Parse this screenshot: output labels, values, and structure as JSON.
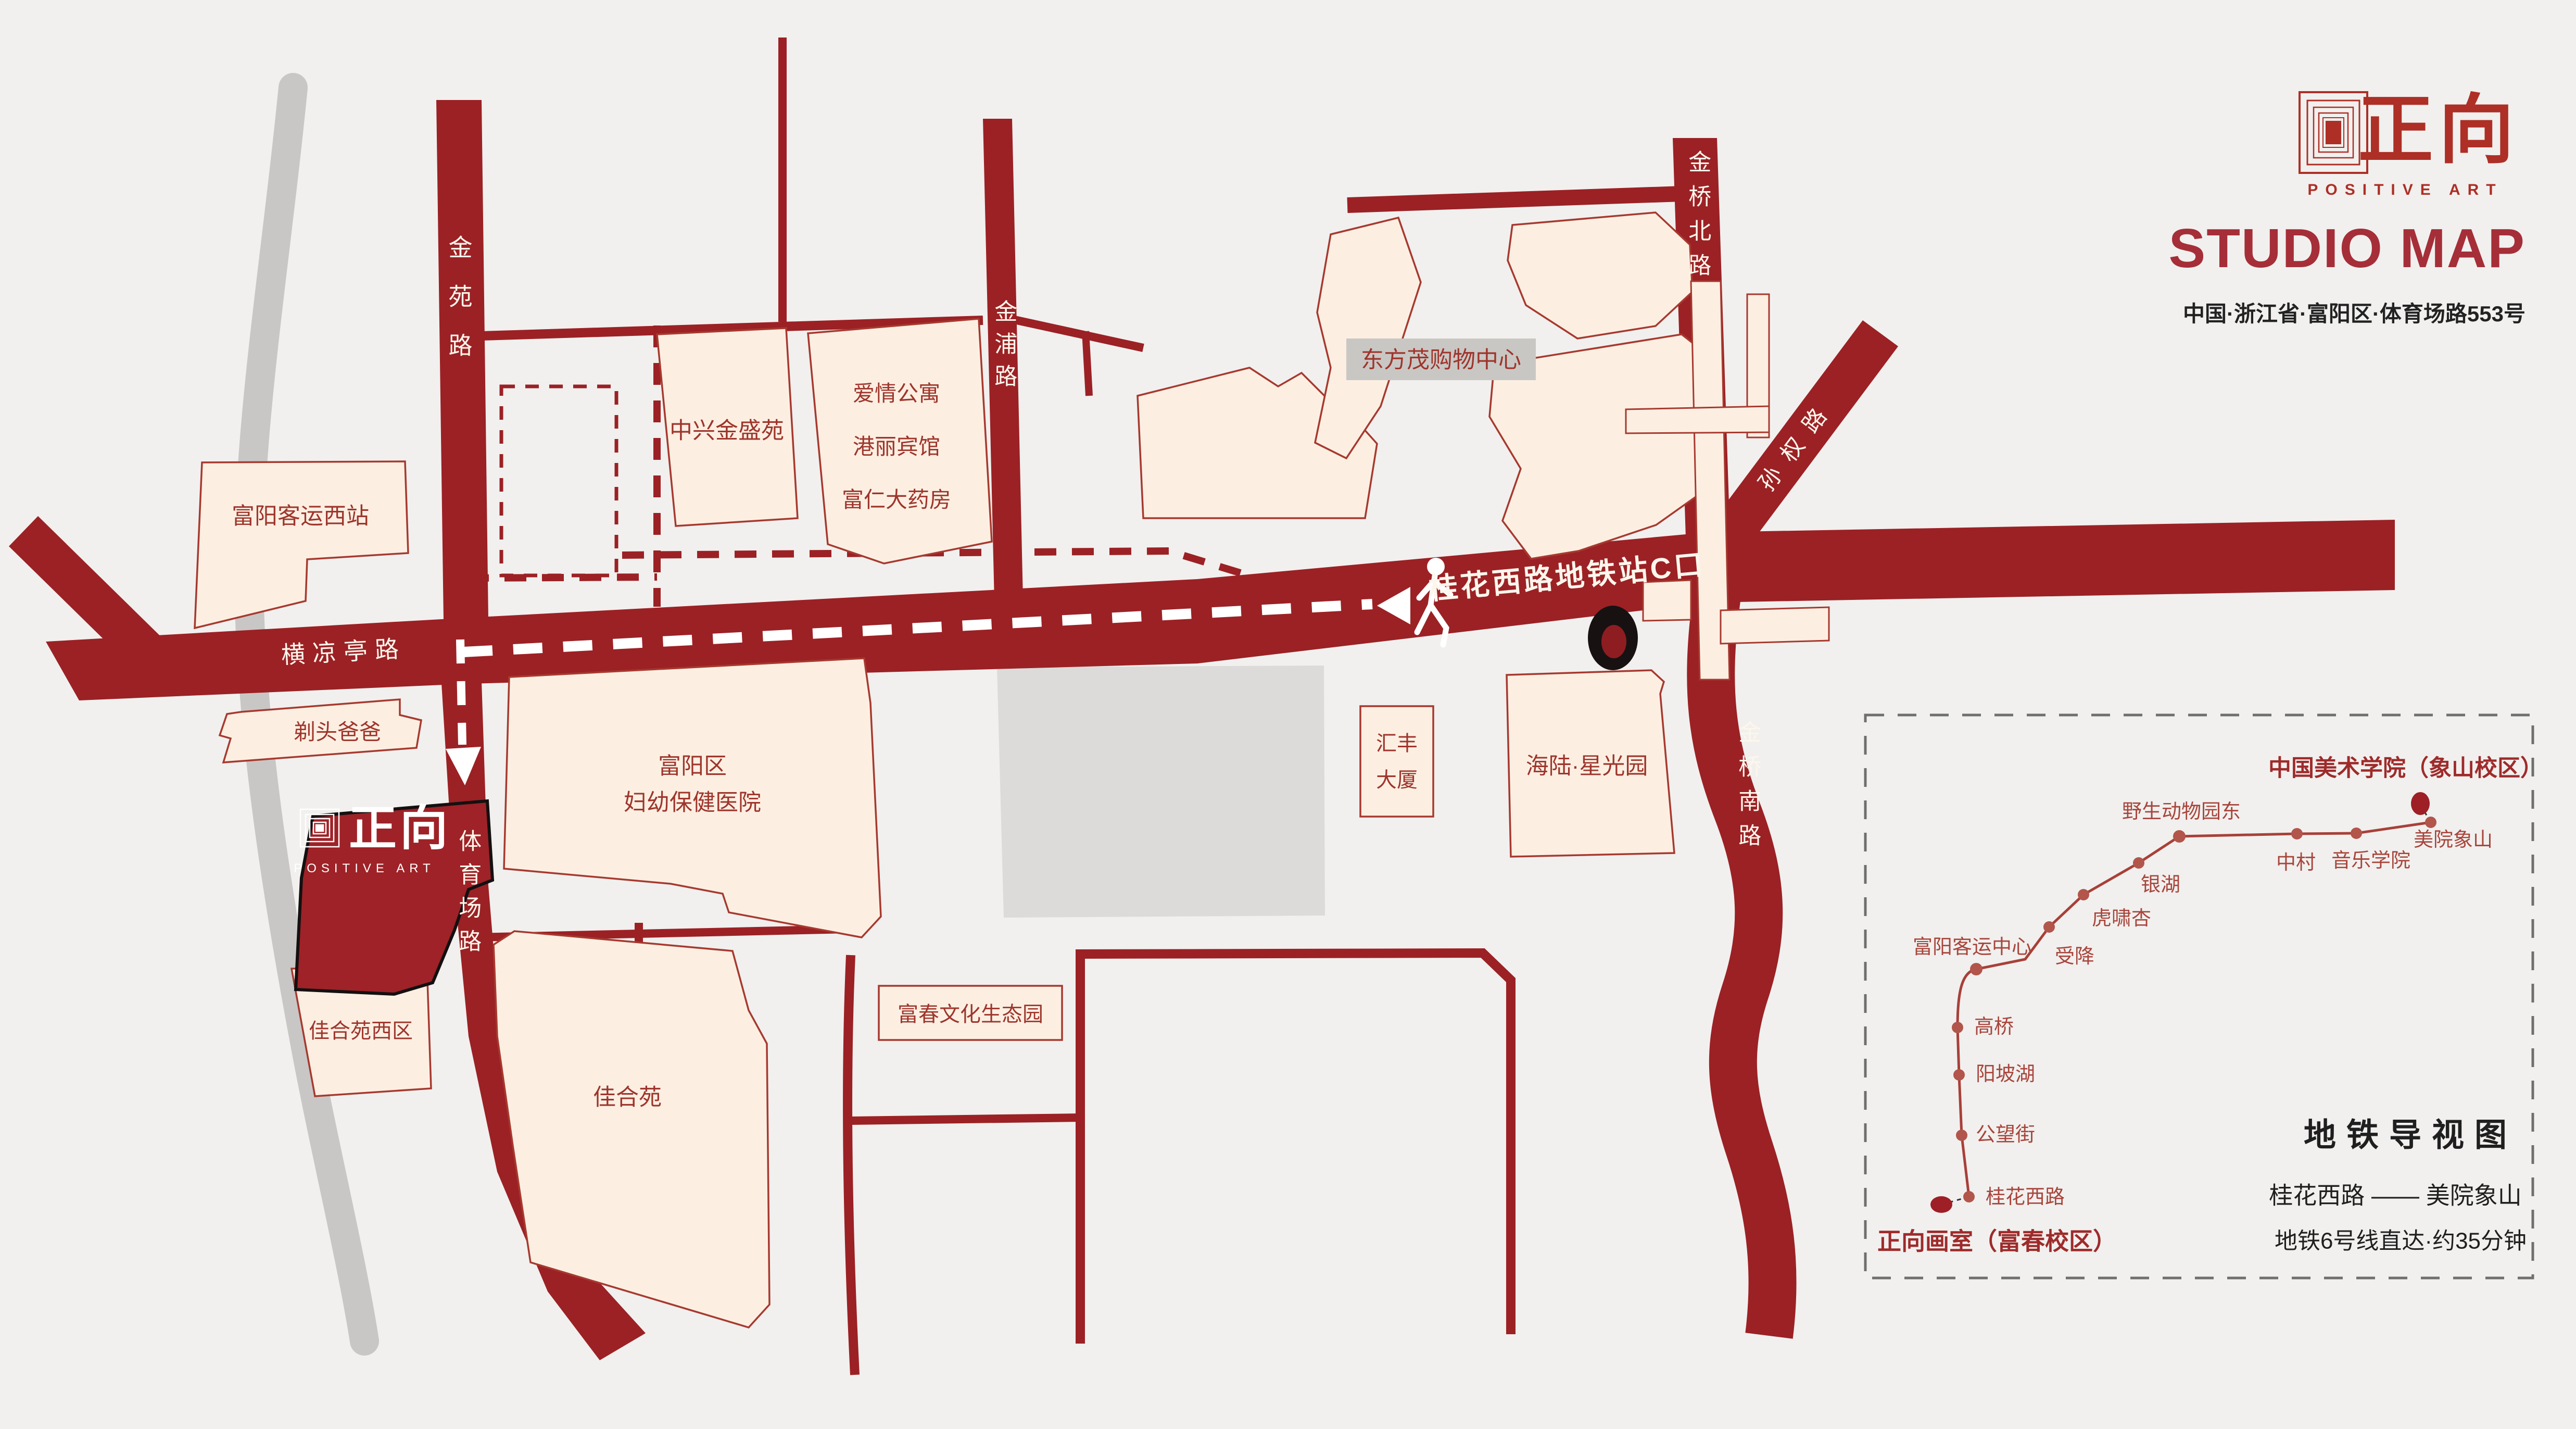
{
  "header": {
    "brand_cn": "正向",
    "brand_en": "POSITIVE ART",
    "title": "STUDIO MAP",
    "address": "中国·浙江省·富阳区·体育场路553号"
  },
  "studio": {
    "brand_cn": "正向",
    "brand_en": "POSITIVE ART"
  },
  "roads": {
    "jinyuan": "金苑路",
    "jinpu": "金浦路",
    "jinqiao_north": "金桥北路",
    "jinqiao_south": "金桥南路",
    "sunquan": "孙权路",
    "hengliangting": "横凉亭路",
    "tiyuchang": "体育场路",
    "metro_exit": "桂花西路地铁站C口"
  },
  "buildings": {
    "bus_station_west": "富阳客运西站",
    "zhongxing": "中兴金盛苑",
    "aiqing": "爱情公寓",
    "gangli": "港丽宾馆",
    "furen": "富仁大药房",
    "dongfangmao": "东方茂购物中心",
    "titou": "剃头爸爸",
    "fuyang_line1": "富阳区",
    "fuyang_line2": "妇幼保健医院",
    "huifeng_line1": "汇丰",
    "huifeng_line2": "大厦",
    "hailu": "海陆·星光园",
    "jiaheyuan_west": "佳合苑西区",
    "jiaheyuan": "佳合苑",
    "fuchun": "富春文化生态园"
  },
  "metro": {
    "title": "地铁导视图",
    "route": "桂花西路 —— 美院象山",
    "note": "地铁6号线直达·约35分钟",
    "start": "正向画室（富春校区）",
    "end": "中国美术学院（象山校区）",
    "stations": [
      "桂花西路",
      "公望街",
      "阳坡湖",
      "高桥",
      "富阳客运中心",
      "受降",
      "虎啸杏",
      "银湖",
      "野生动物园东",
      "中村",
      "音乐学院",
      "美院象山"
    ]
  },
  "colors": {
    "road_red": "#9b2125",
    "building_cream": "#fcefe2",
    "studio_red": "#9e2227",
    "brand_red": "#ad2f26",
    "title_red": "#a52e38",
    "metro_line": "#a84039"
  }
}
